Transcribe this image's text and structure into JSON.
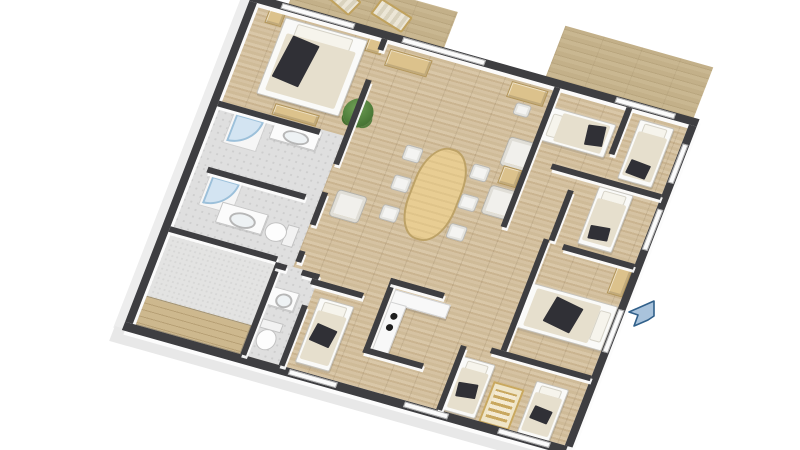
{
  "scene": {
    "title": "3D apartment floor plan render",
    "view": "top-down axonometric, plan rotated clockwise",
    "canvas": {
      "width": 800,
      "height": 450,
      "background": "#ffffff"
    }
  },
  "palette": {
    "wall_top": "#3e3e41",
    "wall_face": "#f2f2f2",
    "facade": "#ededed",
    "wood_floor": "#d0bc9b",
    "deck_wood": "#c2b08a",
    "tile_floor": "#dfdfdf",
    "lounge_floor": "#e3e3e2",
    "bed_duvet": "#e6dfcd",
    "dark_blanket": "#303036",
    "furniture_wood": "#dcc28c",
    "table_top": "#e8cd93",
    "shower_glass": "#b6d6ee",
    "plant_green": "#4c7a38",
    "marker_blue": "#a9c3dc",
    "marker_outline": "#31608a"
  },
  "rooms": [
    {
      "id": "bedroom-1",
      "label": "Bedroom 1 (top left)",
      "floor": "wood",
      "furniture": [
        "double bed with beige duvet and dark throw",
        "nightstand x2",
        "foot bench"
      ]
    },
    {
      "id": "bathroom-1",
      "label": "Bathroom 1",
      "floor": "grey tile",
      "furniture": [
        "corner glass shower",
        "vanity with sink"
      ]
    },
    {
      "id": "bathroom-2",
      "label": "Bathroom 2",
      "floor": "grey tile",
      "furniture": [
        "corner glass shower",
        "vanity with sink",
        "toilet"
      ]
    },
    {
      "id": "lounge",
      "label": "Lounge with wood steps (bottom left)",
      "floor": "grey carpet",
      "furniture": [
        "wooden step benches"
      ]
    },
    {
      "id": "wc",
      "label": "WC",
      "floor": "grey tile",
      "furniture": [
        "hand basin",
        "toilet"
      ]
    },
    {
      "id": "living-dining",
      "label": "Living / dining room (center)",
      "floor": "wood",
      "furniture": [
        "oval dining table",
        "dining chair x6",
        "armchair (left)",
        "armchair x2 (right)",
        "side table",
        "sideboard",
        "desk with chair",
        "potted plant"
      ]
    },
    {
      "id": "kitchen",
      "label": "Kitchen nook",
      "floor": "wood",
      "furniture": [
        "L-shaped white counter",
        "cooktop with 2 burners"
      ]
    },
    {
      "id": "bedroom-2",
      "label": "Bedroom 2 (top right, beside deck)",
      "floor": "wood",
      "furniture": [
        "single bed"
      ]
    },
    {
      "id": "bedroom-3",
      "label": "Bedroom 3 (right, upper)",
      "floor": "wood",
      "furniture": [
        "single bed"
      ]
    },
    {
      "id": "bedroom-4",
      "label": "Bedroom 4 (right, middle)",
      "floor": "wood",
      "furniture": [
        "single bed"
      ]
    },
    {
      "id": "bedroom-5",
      "label": "Bedroom 5 (bottom right)",
      "floor": "wood",
      "furniture": [
        "double bed with dark throw",
        "dresser"
      ]
    },
    {
      "id": "kids-room",
      "label": "Kids room (bottom)",
      "floor": "wood",
      "furniture": [
        "single bed",
        "crib",
        "single bed"
      ]
    },
    {
      "id": "bedroom-6",
      "label": "Bedroom 6 (bottom center-left)",
      "floor": "wood",
      "furniture": [
        "single bed"
      ]
    }
  ],
  "outdoor": {
    "decks": [
      {
        "id": "deck-top-center",
        "label": "Wood deck (top center)",
        "items": [
          "sun lounger x2"
        ]
      },
      {
        "id": "deck-top-right",
        "label": "Wood deck (top right)",
        "items": []
      }
    ]
  },
  "marker": {
    "id": "entry-arrow",
    "label": "Blue entry arrow marker",
    "color": "#a9c3dc"
  }
}
